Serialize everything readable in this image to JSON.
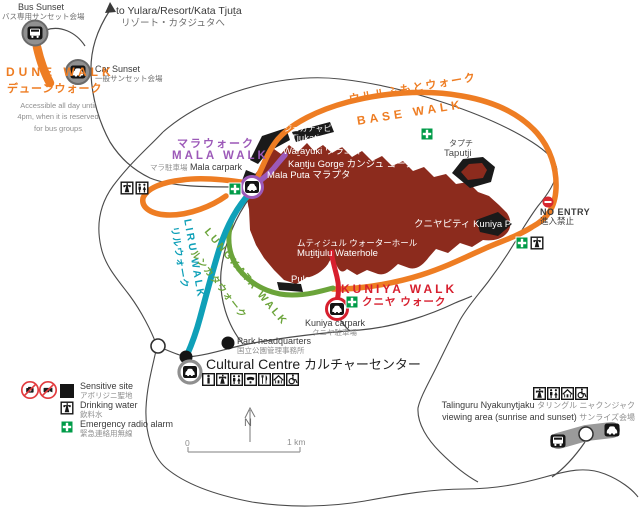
{
  "sunset": {
    "bus_en": "Bus Sunset",
    "bus_ja": "バス専用サンセット会場",
    "car_en": "Car Sunset",
    "car_ja": "一般サンセット会場",
    "to_yulara_en": "to Yulara/Resort/Kata Tjuṯa",
    "to_yulara_ja": "リゾート・カタジュタへ"
  },
  "walks": {
    "dune_en": "DUNE WALK",
    "dune_ja": "デューンウォーク",
    "dune_note": "Accessible all day until 4pm, when it is reserved for bus groups",
    "mala_ja": "マラウォーク",
    "mala_en": "MALA WALK",
    "base_ja": "ウルルふもとウォーク",
    "base_en": "BASE WALK",
    "liru_en": "LIRU WALK",
    "liru_ja": "リルウォーク",
    "lungkata_en": "LUNGKATA WALK",
    "lungkata_ja": "ルンカタウォーク",
    "kuniya_en": "KUNIYA WALK",
    "kuniya_ja": "クニヤ ウォーク"
  },
  "carparks": {
    "mala_ja": "マラ駐車場",
    "mala_en": "Mala carpark",
    "kuniya_en": "Kuniya carpark",
    "kuniya_ja": "クニヤ駐車場"
  },
  "facilities": {
    "park_hq_en": "Park headquarters",
    "park_hq_ja": "国立公園管理事務所",
    "cc_en": "Cultural Centre",
    "cc_ja": "カルチャーセンター",
    "talinguru_en": "Talinguru Nyakunytjaku",
    "talinguru_ja": "タリングル ニャクンジャク",
    "viewing_en": "viewing area (sunrise and sunset)",
    "viewing_ja": "サンライズ会場"
  },
  "rock": {
    "tjukatjapi_ja": "ジュカチャピ",
    "tjukatjapi_en": "Tjukatjapi",
    "warayuki": "Waṟayuki ワラユキ",
    "kantju": "Kaṉtju Gorge カンジュ ゴージ",
    "mala_puta": "Mala Puta マラプタ",
    "taputji_ja": "タプチ",
    "taputji_en": "Taputji",
    "kuniya_piti": "クニヤピティ Kuniya Piṯi",
    "mutitjulu_ja": "ムティジュル ウォーターホール",
    "mutitjulu_en": "Muṯitjulu Waterhole",
    "pulari": "Pulari"
  },
  "no_entry": {
    "en": "NO ENTRY",
    "ja": "進入禁止"
  },
  "legend": {
    "sensitive_en": "Sensitive site",
    "sensitive_ja": "アボリジニ聖地",
    "water_en": "Drinking water",
    "water_ja": "飲料水",
    "radio_en": "Emergency radio alarm",
    "radio_ja": "緊急連絡用無線"
  },
  "scalebar": {
    "zero": "0",
    "one_km": "1 km"
  },
  "compass": {
    "north": "N"
  },
  "colors": {
    "base_orange": "#EE7D23",
    "mala_purple": "#9C59B8",
    "liru_teal": "#0FA0B8",
    "lungkata_green": "#6BA43A",
    "kuniya_red": "#D71F2E",
    "rock_maroon": "#8C2B1D",
    "sensitive_black": "#1A1A1A",
    "first_aid_green": "#009B48"
  },
  "icons": [
    "bus-icon",
    "car-icon",
    "drinking-water-icon",
    "toilets-icon",
    "first-aid-icon",
    "no-entry-icon",
    "no-photography-icon",
    "no-video-icon",
    "sensitive-site-icon",
    "information-icon",
    "telephone-icon",
    "food-icon",
    "shelter-icon",
    "wheelchair-access-icon",
    "north-arrow",
    "scale-bar",
    "arrow-to-yulara"
  ]
}
